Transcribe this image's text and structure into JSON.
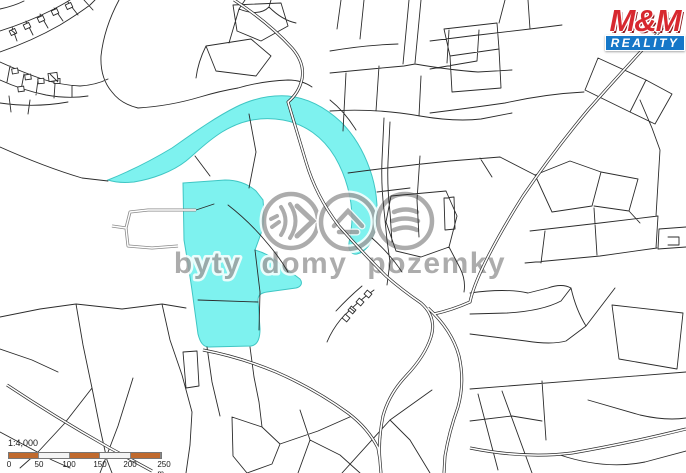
{
  "map": {
    "background": "#ffffff",
    "line_color": "#2b2b2b",
    "highlight_color": "#7ef2ef",
    "highlight_border": "#3fc6c4",
    "description": "cadastral parcel map with highlighted land plots"
  },
  "watermark": {
    "text": "byty domy pozemky",
    "color": "#9e9e9e",
    "icons": [
      "signal-waves-icon",
      "house-roof-icon",
      "field-layers-icon"
    ]
  },
  "logo": {
    "name": "M&M",
    "subtitle": "REALITY",
    "name_color": "#d7282f",
    "subtitle_bg": "#1577c8"
  },
  "scalebar": {
    "ratio_label": "1:4,000",
    "tick_labels": [
      "0",
      "50",
      "100",
      "150",
      "200",
      "250 m"
    ],
    "bar_color": "#c06a2e"
  }
}
